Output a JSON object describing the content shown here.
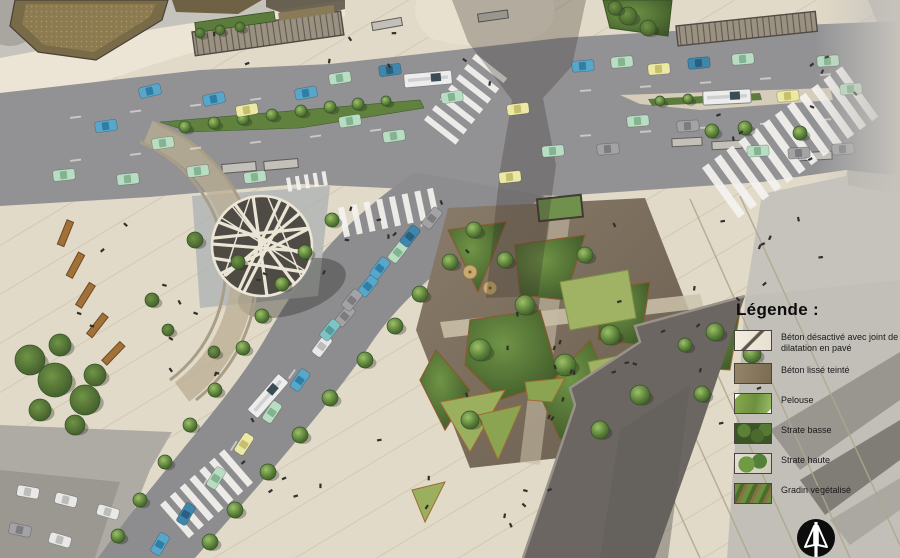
{
  "legend": {
    "title": "Légende :",
    "items": [
      {
        "id": "beton-desactive",
        "label": "Béton désactivé avec joint de dilatation en pavé"
      },
      {
        "id": "beton-lisse",
        "label": "Béton lissé teinté"
      },
      {
        "id": "pelouse",
        "label": "Pelouse"
      },
      {
        "id": "strate-basse",
        "label": "Strate basse"
      },
      {
        "id": "strate-haute",
        "label": "Strate haute"
      },
      {
        "id": "gradin-vegetalise",
        "label": "Gradin végétalisé"
      }
    ]
  },
  "compass": {
    "icon": "north-arrow-icon"
  },
  "colors": {
    "road": "#929295",
    "plaza_concrete": "#e2dac8",
    "smooth_concrete": "#877a5f",
    "lawn": "#a0b264",
    "low_vegetation": "#4c6e33",
    "high_vegetation": "#6f9446",
    "garden_soil": "#776a59",
    "building_roof": "#6b6661",
    "aerial_photo": "#c6c3bd",
    "crosswalk": "#f5f4f0",
    "legend_text": "#191919"
  }
}
